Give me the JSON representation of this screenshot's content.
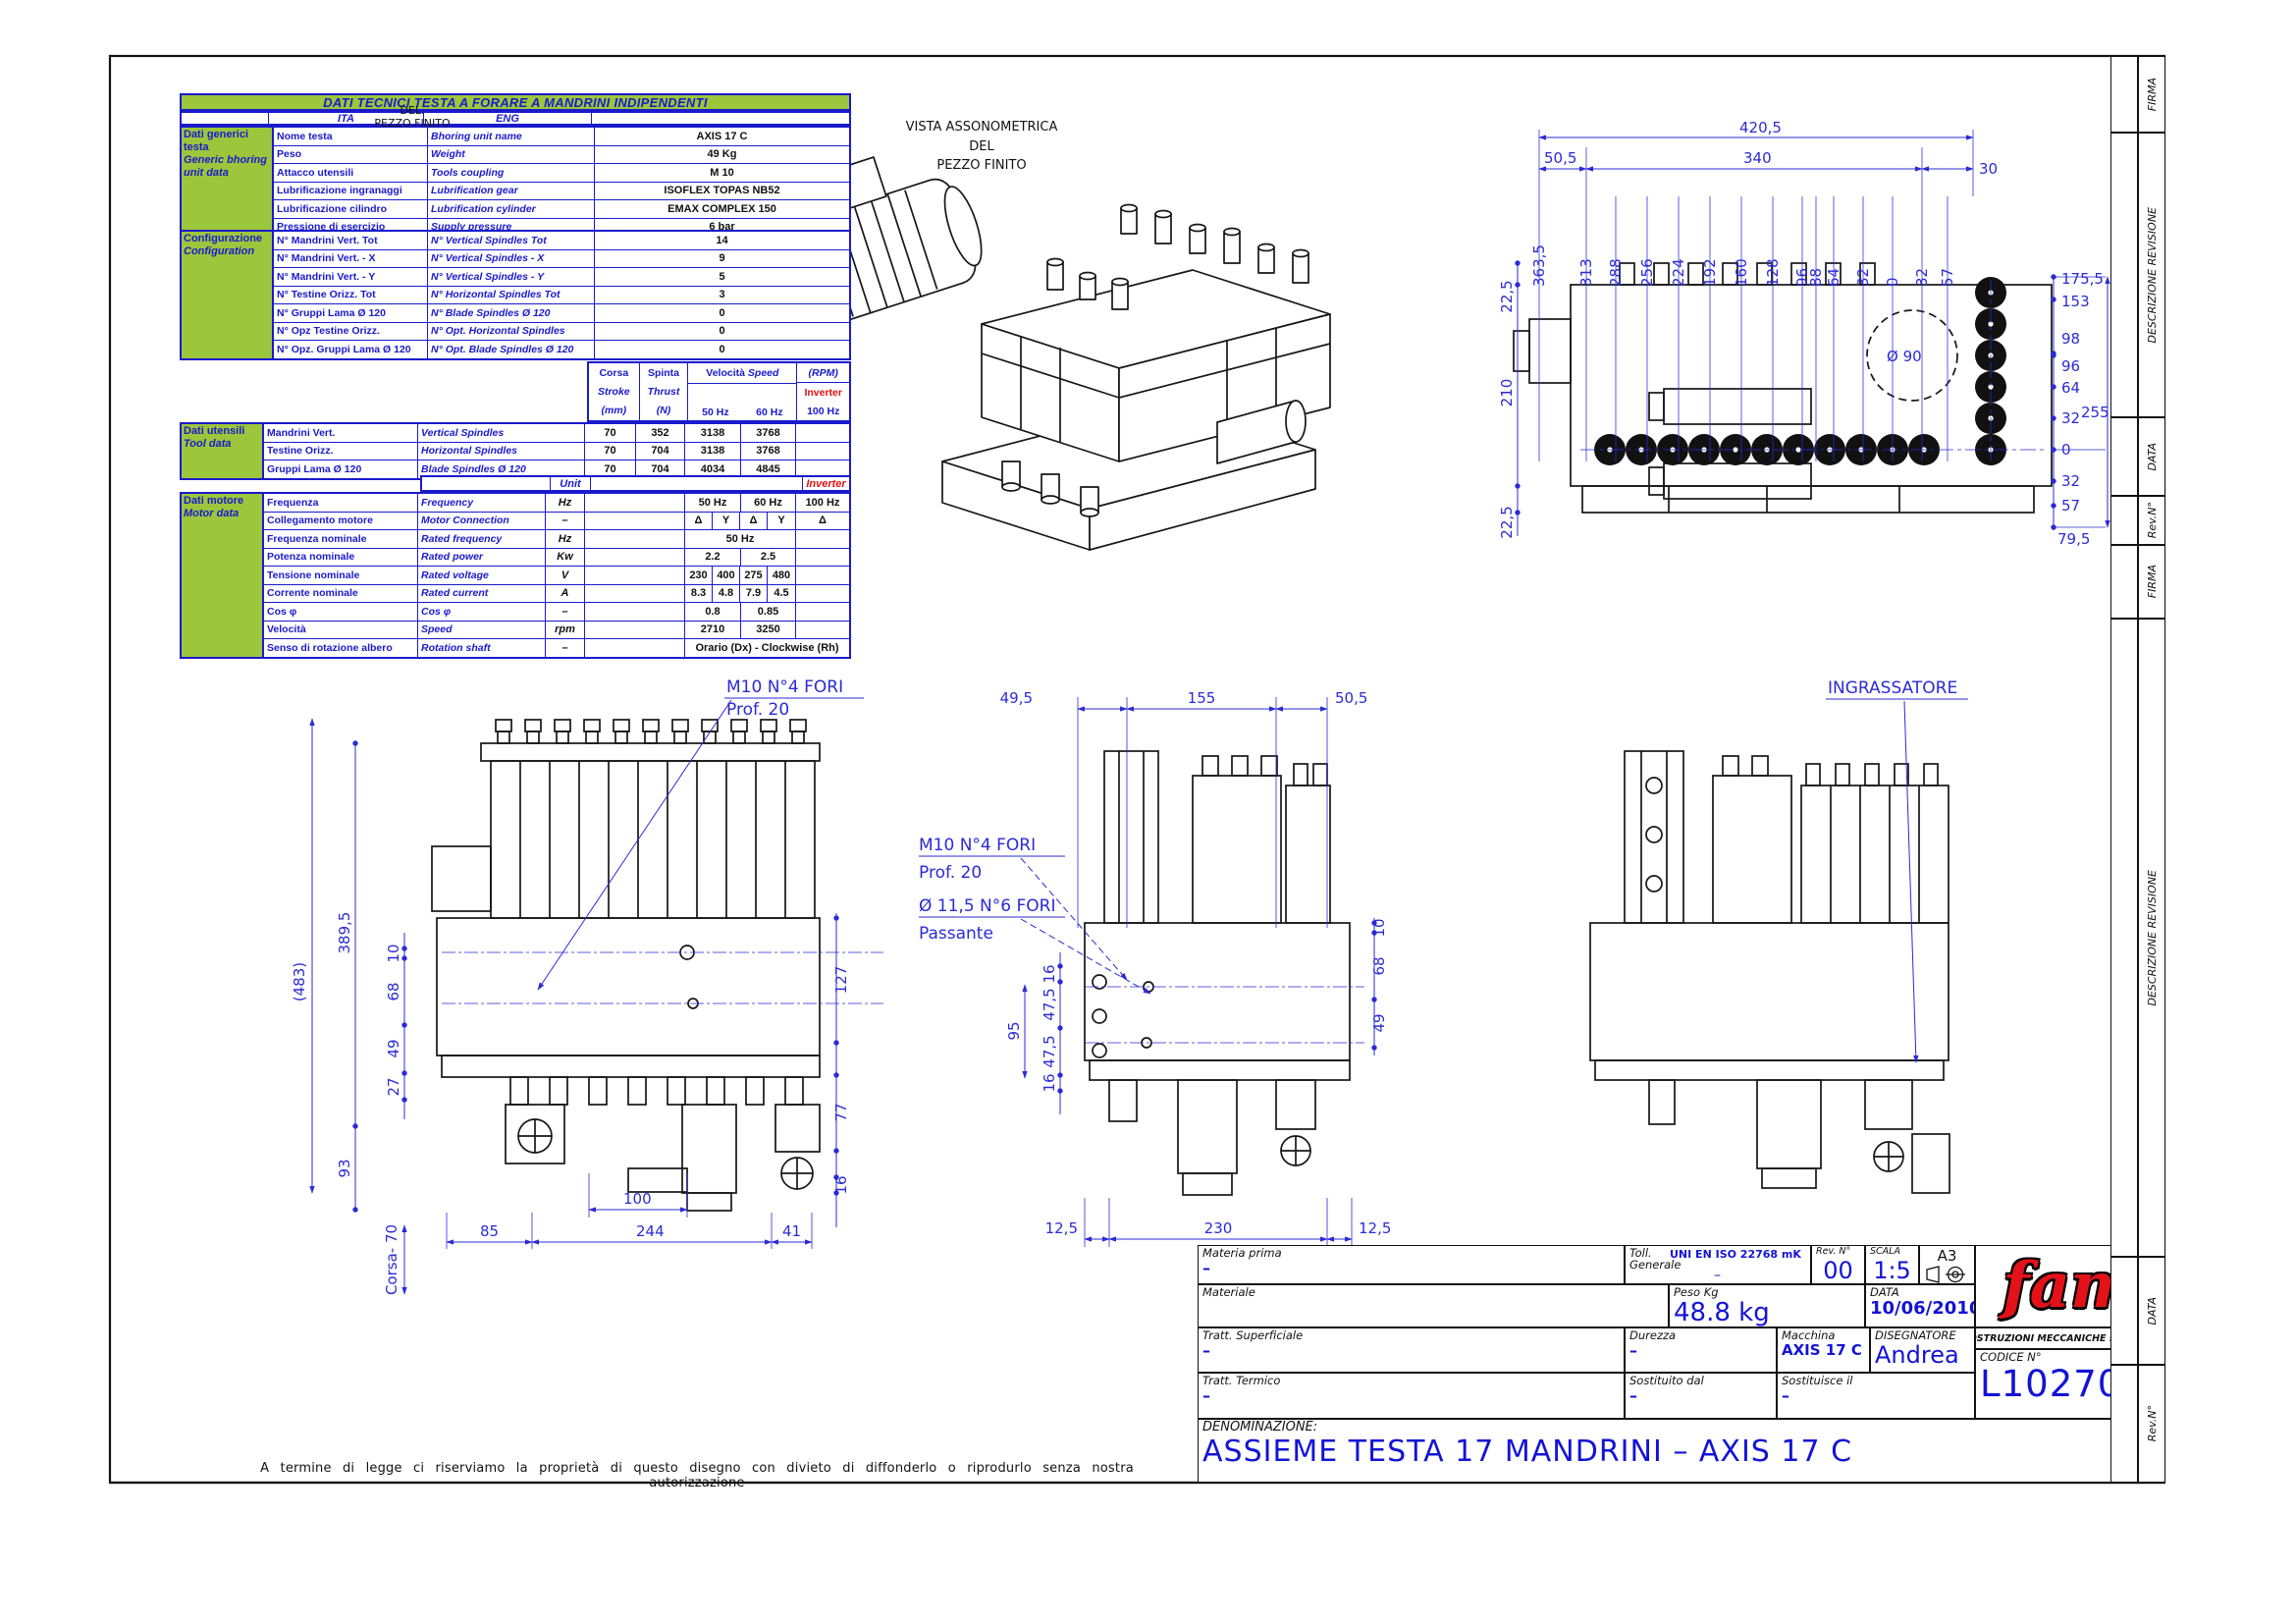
{
  "sheet": {
    "legal_text": "A termine di legge ci riserviamo la proprietà di questo disegno con divieto di diffonderlo o riprodurlo senza nostra autorizzazione"
  },
  "revision_strip": {
    "labels": [
      "FIRMA",
      "DESCRIZIONE REVISIONE",
      "DATA",
      "Rev.N°"
    ]
  },
  "tech_table": {
    "title": "DATI TECNICI TESTA A FORARE A MANDRINI INDIPENDENTI",
    "col_ita": "ITA",
    "col_eng": "ENG",
    "generic": {
      "label_ita": "Dati generici testa",
      "label_eng": "Generic bhoring unit data",
      "rows": [
        {
          "ita": "Nome testa",
          "eng": "Bhoring unit name",
          "val": "AXIS 17 C"
        },
        {
          "ita": "Peso",
          "eng": "Weight",
          "val": "49 Kg"
        },
        {
          "ita": "Attacco utensili",
          "eng": "Tools coupling",
          "val": "M 10"
        },
        {
          "ita": "Lubrificazione ingranaggi",
          "eng": "Lubrification gear",
          "val": "ISOFLEX TOPAS NB52"
        },
        {
          "ita": "Lubrificazione cilindro",
          "eng": "Lubrification cylinder",
          "val": "EMAX COMPLEX 150"
        },
        {
          "ita": "Pressione di esercizio",
          "eng": "Supply pressure",
          "val": "6 bar"
        }
      ]
    },
    "config": {
      "label_ita": "Configurazione",
      "label_eng": "Configuration",
      "rows": [
        {
          "ita": "N° Mandrini Vert. Tot",
          "eng": "N° Vertical Spindles Tot",
          "val": "14"
        },
        {
          "ita": "N° Mandrini Vert. - X",
          "eng": "N° Vertical Spindles - X",
          "val": "9"
        },
        {
          "ita": "N° Mandrini Vert. - Y",
          "eng": "N° Vertical Spindles - Y",
          "val": "5"
        },
        {
          "ita": "N° Testine Orizz. Tot",
          "eng": "N° Horizontal Spindles Tot",
          "val": "3"
        },
        {
          "ita": "N° Gruppi Lama Ø 120",
          "eng": "N° Blade Spindles Ø 120",
          "val": "0"
        },
        {
          "ita": "N° Opz Testine Orizz.",
          "eng": "N° Opt. Horizontal Spindles",
          "val": "0"
        },
        {
          "ita": "N° Opz. Gruppi Lama Ø 120",
          "eng": "N° Opt. Blade Spindles Ø 120",
          "val": "0"
        }
      ]
    },
    "speed_header": {
      "corsa_ita": "Corsa",
      "corsa_eng": "Stroke",
      "corsa_unit": "(mm)",
      "spinta_ita": "Spinta",
      "spinta_eng": "Thrust",
      "spinta_unit": "(N)",
      "vel_ita": "Velocità",
      "vel_eng": "Speed",
      "rpm": "(RPM)",
      "hz50": "50 Hz",
      "hz60": "60 Hz",
      "inverter": "Inverter",
      "hz100": "100 Hz"
    },
    "tool": {
      "label_ita": "Dati utensili",
      "label_eng": "Tool data",
      "rows": [
        {
          "ita": "Mandrini Vert.",
          "eng": "Vertical Spindles",
          "corsa": "70",
          "spinta": "352",
          "v50": "3138",
          "v60": "3768"
        },
        {
          "ita": "Testine Orizz.",
          "eng": "Horizontal Spindles",
          "corsa": "70",
          "spinta": "704",
          "v50": "3138",
          "v60": "3768"
        },
        {
          "ita": "Gruppi Lama Ø 120",
          "eng": "Blade Spindles Ø 120",
          "corsa": "70",
          "spinta": "704",
          "v50": "4034",
          "v60": "4845"
        }
      ]
    },
    "motor": {
      "label_ita": "Dati motore",
      "label_eng": "Motor data",
      "unit_header": "Unit",
      "inverter": "Inverter",
      "rows": [
        {
          "ita": "Frequenza",
          "eng": "Frequency",
          "unit": "Hz",
          "c1": "50 Hz",
          "c2": "60 Hz",
          "inv": "100 Hz"
        },
        {
          "ita": "Collegamento motore",
          "eng": "Motor Connection",
          "unit": "–",
          "c1": "Δ",
          "c2": "Y",
          "c3": "Δ",
          "c4": "Y",
          "inv": "Δ"
        },
        {
          "ita": "Frequenza nominale",
          "eng": "Rated frequency",
          "unit": "Hz",
          "c1": "50 Hz"
        },
        {
          "ita": "Potenza nominale",
          "eng": "Rated power",
          "unit": "Kw",
          "c1": "2.2",
          "c2": "2.5"
        },
        {
          "ita": "Tensione nominale",
          "eng": "Rated voltage",
          "unit": "V",
          "c1": "230",
          "c2": "400",
          "c3": "275",
          "c4": "480"
        },
        {
          "ita": "Corrente nominale",
          "eng": "Rated current",
          "unit": "A",
          "c1": "8.3",
          "c2": "4.8",
          "c3": "7.9",
          "c4": "4.5"
        },
        {
          "ita": "Cos φ",
          "eng": "Cos φ",
          "unit": "–",
          "c1": "0.8",
          "c2": "0.85"
        },
        {
          "ita": "Velocità",
          "eng": "Speed",
          "unit": "rpm",
          "c1": "2710",
          "c2": "3250"
        },
        {
          "ita": "Senso di rotazione albero",
          "eng": "Rotation shaft",
          "unit": "–",
          "c1": "Orario (Dx) - Clockwise (Rh)"
        }
      ]
    }
  },
  "iso_view": {
    "label_1": "VISTA ASSONOMETRICA",
    "label_2": "DEL",
    "label_3": "PEZZO FINITO",
    "artifact_1": "DEL.",
    "artifact_2": "PEZZO FINITO"
  },
  "top_view": {
    "dim_total": "420,5",
    "dim_left": "50,5",
    "dim_mid": "340",
    "dim_right": "30",
    "x_dims": [
      "363,5",
      "313",
      "288",
      "256",
      "224",
      "192",
      "160",
      "128",
      "96",
      "88",
      "64",
      "32",
      "0",
      "32",
      "57"
    ],
    "left_dims": [
      "22,5",
      "210",
      "22,5"
    ],
    "right_dims": [
      "175,5",
      "153",
      "98",
      "96",
      "64",
      "32",
      "0",
      "32",
      "57",
      "79,5"
    ],
    "dim_255": "255",
    "circle_label": "Ø 90"
  },
  "front_view": {
    "dim_483": "(483)",
    "dim_3895": "389,5",
    "dim_93": "93",
    "dim_10": "10",
    "dim_68": "68",
    "dim_49": "49",
    "dim_27": "27",
    "corsa": "Corsa- 70",
    "dim_85": "85",
    "dim_244": "244",
    "dim_100": "100",
    "dim_41": "41",
    "dim_127": "127",
    "dim_77": "77",
    "dim_16": "16",
    "note_1": "M10   N°4 FORI",
    "note_2": "Prof. 20"
  },
  "side_view": {
    "dim_495": "49,5",
    "dim_155": "155",
    "dim_505": "50,5",
    "dim_95": "95",
    "dim_16a": "16",
    "dim_475a": "47,5",
    "dim_475b": "47,5",
    "dim_16b": "16",
    "dim_10": "10",
    "dim_68": "68",
    "dim_49": "49",
    "dim_125a": "12,5",
    "dim_230": "230",
    "dim_125b": "12,5",
    "note_1": "M10   N°4 FORI",
    "note_2": "Prof. 20",
    "note_3": "Ø 11,5  N°6 FORI",
    "note_4": "Passante"
  },
  "rear_view": {
    "note": "INGRASSATORE"
  },
  "title_block": {
    "materia_prima": {
      "label": "Materia prima",
      "value": "–"
    },
    "materiale": {
      "label": "Materiale",
      "value": ""
    },
    "tratt_superficiale": {
      "label": "Tratt. Superficiale",
      "value": "–"
    },
    "tratt_termico": {
      "label": "Tratt. Termico",
      "value": "–"
    },
    "toll": {
      "label_1": "Toll.",
      "label_2": "Generale",
      "value": "UNI EN ISO 22768 mK",
      "dash": "–"
    },
    "rev": {
      "label": "Rev. N°",
      "value": "00"
    },
    "scala": {
      "label": "SCALA",
      "value": "1:5"
    },
    "formato": "A3",
    "peso": {
      "label": "Peso Kg",
      "value": "48.8 kg"
    },
    "data": {
      "label": "DATA",
      "value": "10/06/2010"
    },
    "durezza": {
      "label": "Durezza",
      "value": "–"
    },
    "macchina": {
      "label": "Macchina",
      "value": "AXIS 17 C"
    },
    "disegnatore": {
      "label": "DISEGNATORE",
      "value": "Andrea"
    },
    "sostituito": {
      "label": "Sostituito dal",
      "value": "–"
    },
    "sostituisce": {
      "label": "Sostituisce il",
      "value": "–"
    },
    "logo": "fam",
    "company": "COSTRUZIONI MECCANICHE s.r.l. PESARO",
    "codice": {
      "label": "CODICE N°",
      "value": "L10270001"
    },
    "denominazione": {
      "label": "DENOMINAZIONE:",
      "value": "ASSIEME TESTA 17 MANDRINI – AXIS 17 C"
    }
  }
}
